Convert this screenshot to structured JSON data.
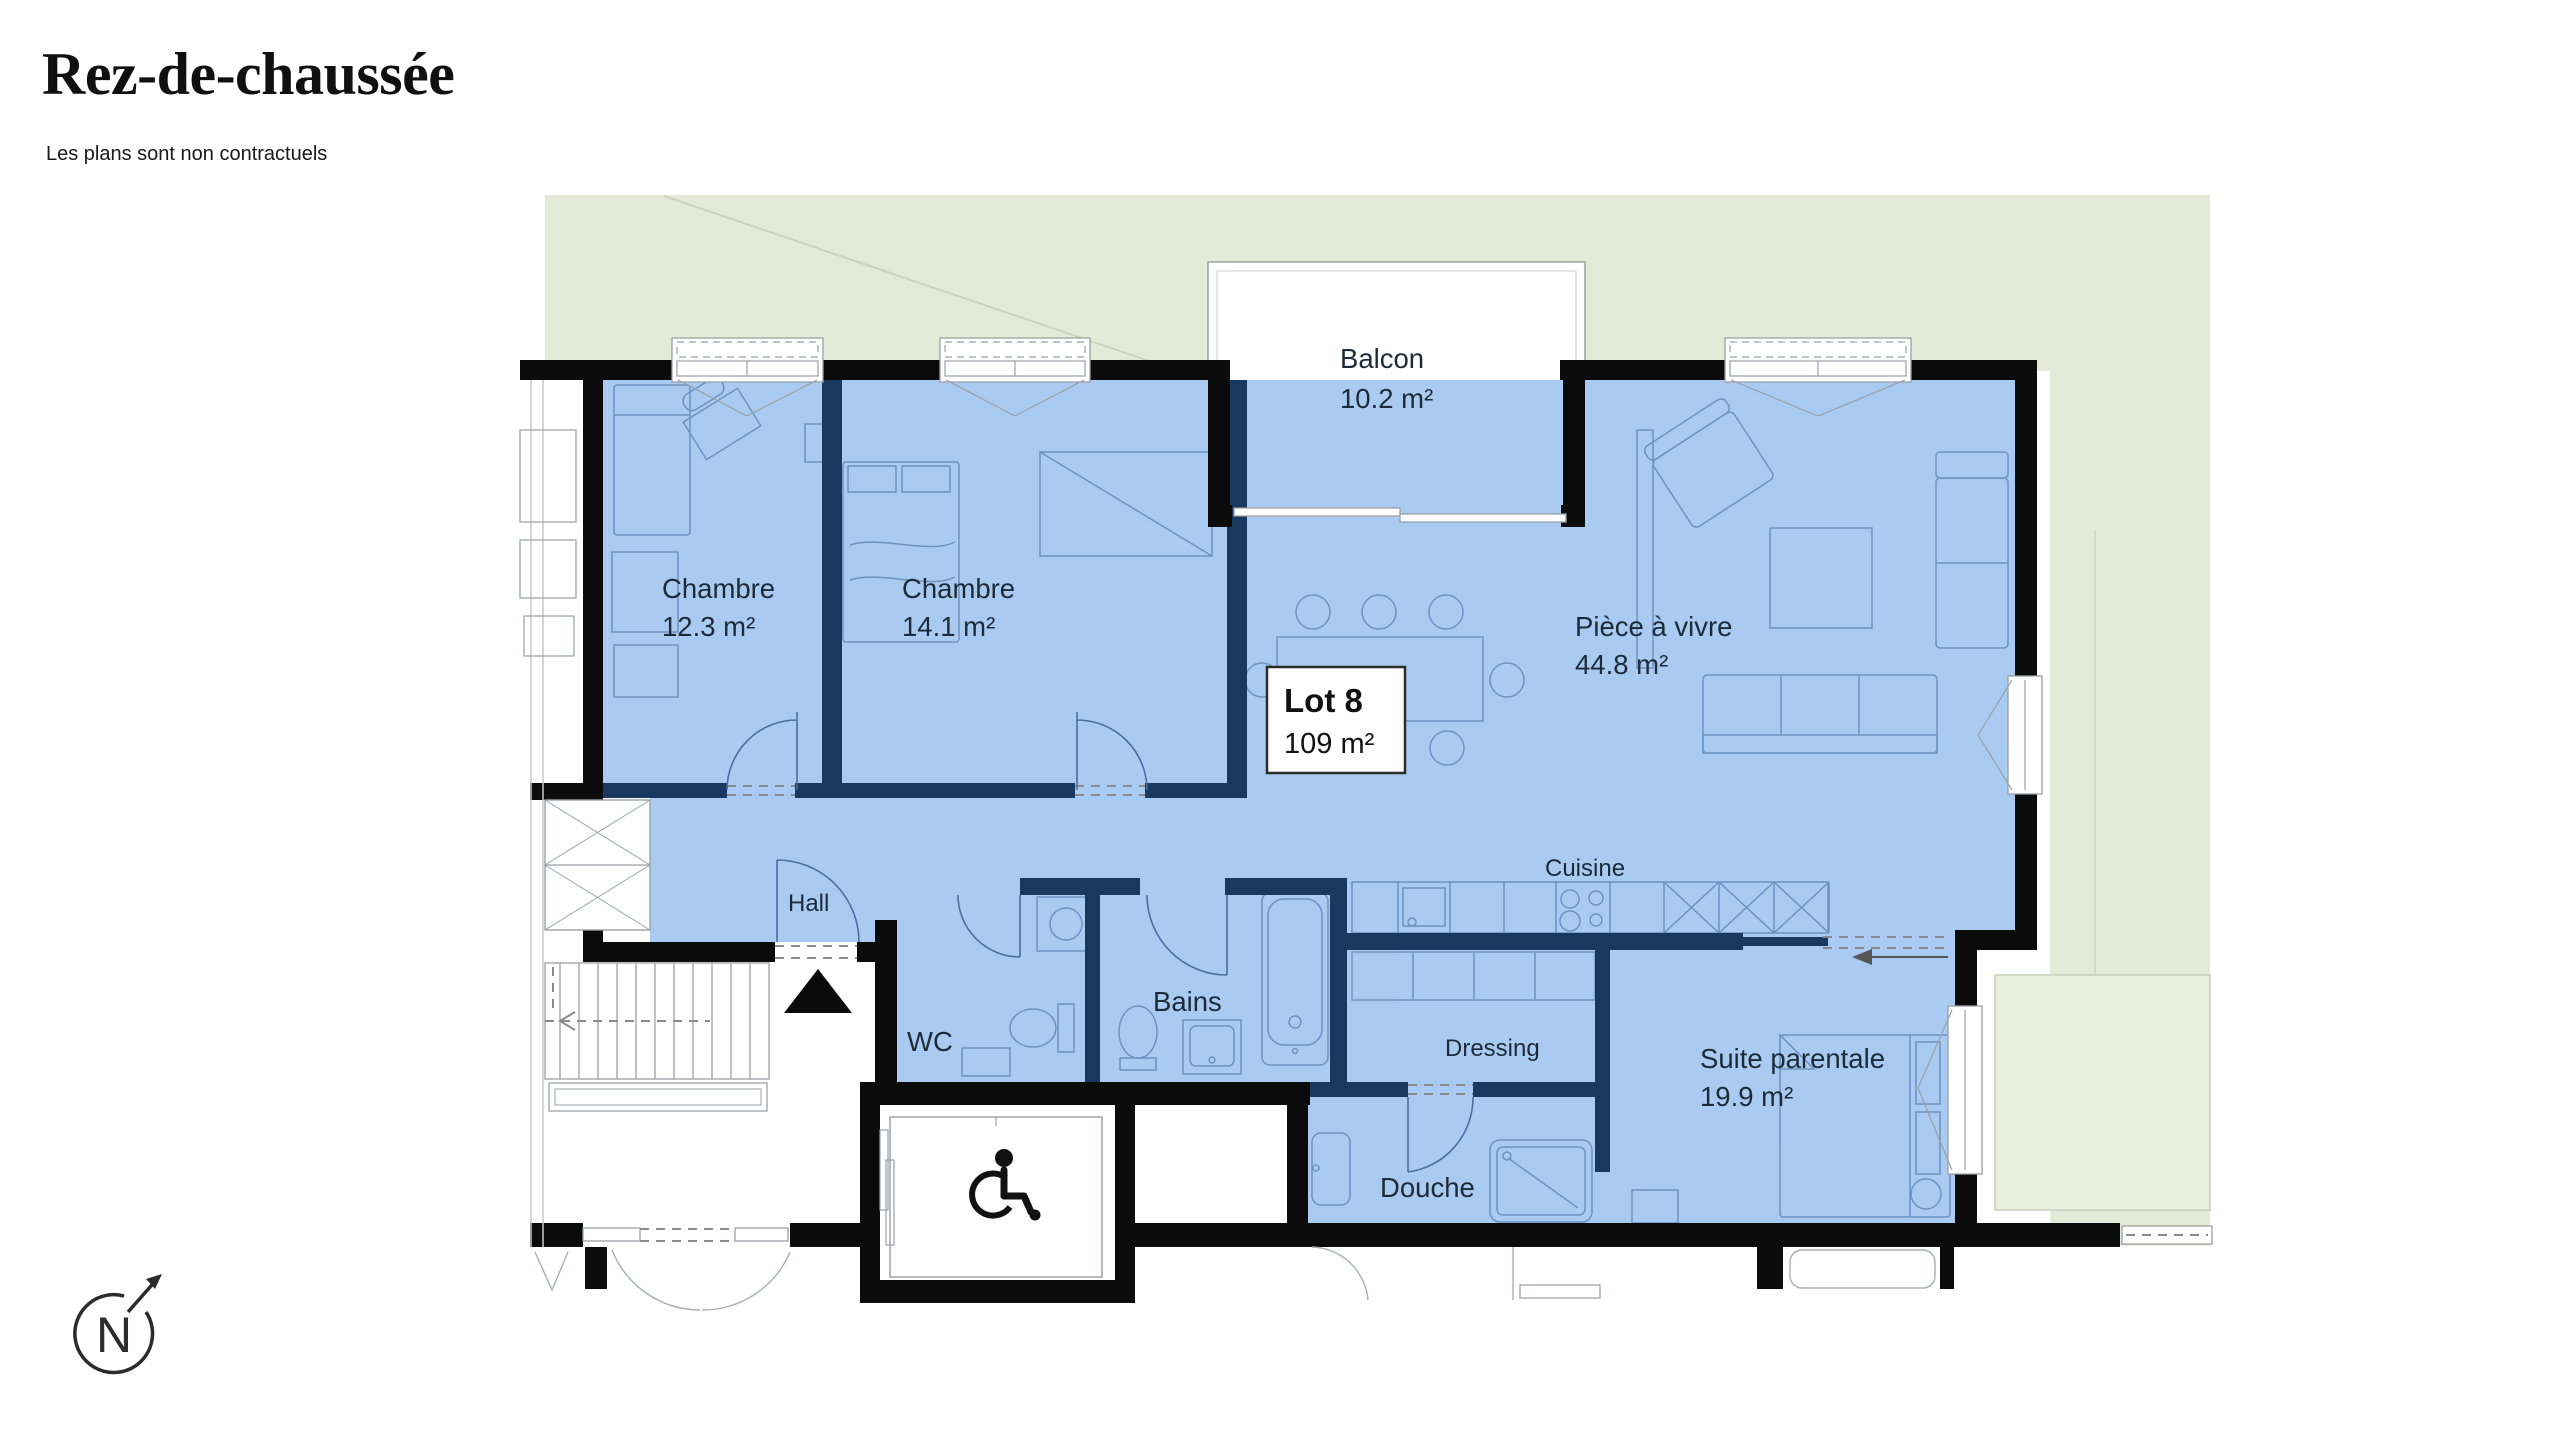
{
  "page": {
    "title": "Rez-de-chaussée",
    "disclaimer": "Les plans sont non contractuels"
  },
  "lot": {
    "name": "Lot 8",
    "area": "109 m²"
  },
  "rooms": {
    "balcon": {
      "label": "Balcon",
      "area": "10.2 m²"
    },
    "chambre1": {
      "label": "Chambre",
      "area": "12.3 m²"
    },
    "chambre2": {
      "label": "Chambre",
      "area": "14.1 m²"
    },
    "piece_a_vivre": {
      "label": "Pièce à vivre",
      "area": "44.8 m²"
    },
    "hall": {
      "label": "Hall"
    },
    "wc": {
      "label": "WC"
    },
    "bains": {
      "label": "Bains"
    },
    "cuisine": {
      "label": "Cuisine"
    },
    "dressing": {
      "label": "Dressing"
    },
    "douche": {
      "label": "Douche"
    },
    "suite_parentale": {
      "label": "Suite parentale",
      "area": "19.9 m²"
    }
  },
  "compass": {
    "north_label": "N"
  },
  "colors": {
    "apartment_fill": "#A9CBF1",
    "common_green": "#E4EAD7",
    "terrace_green": "#EAEFDD",
    "interior_wall": "#17395F",
    "structural_wall": "#0B0B0B"
  }
}
